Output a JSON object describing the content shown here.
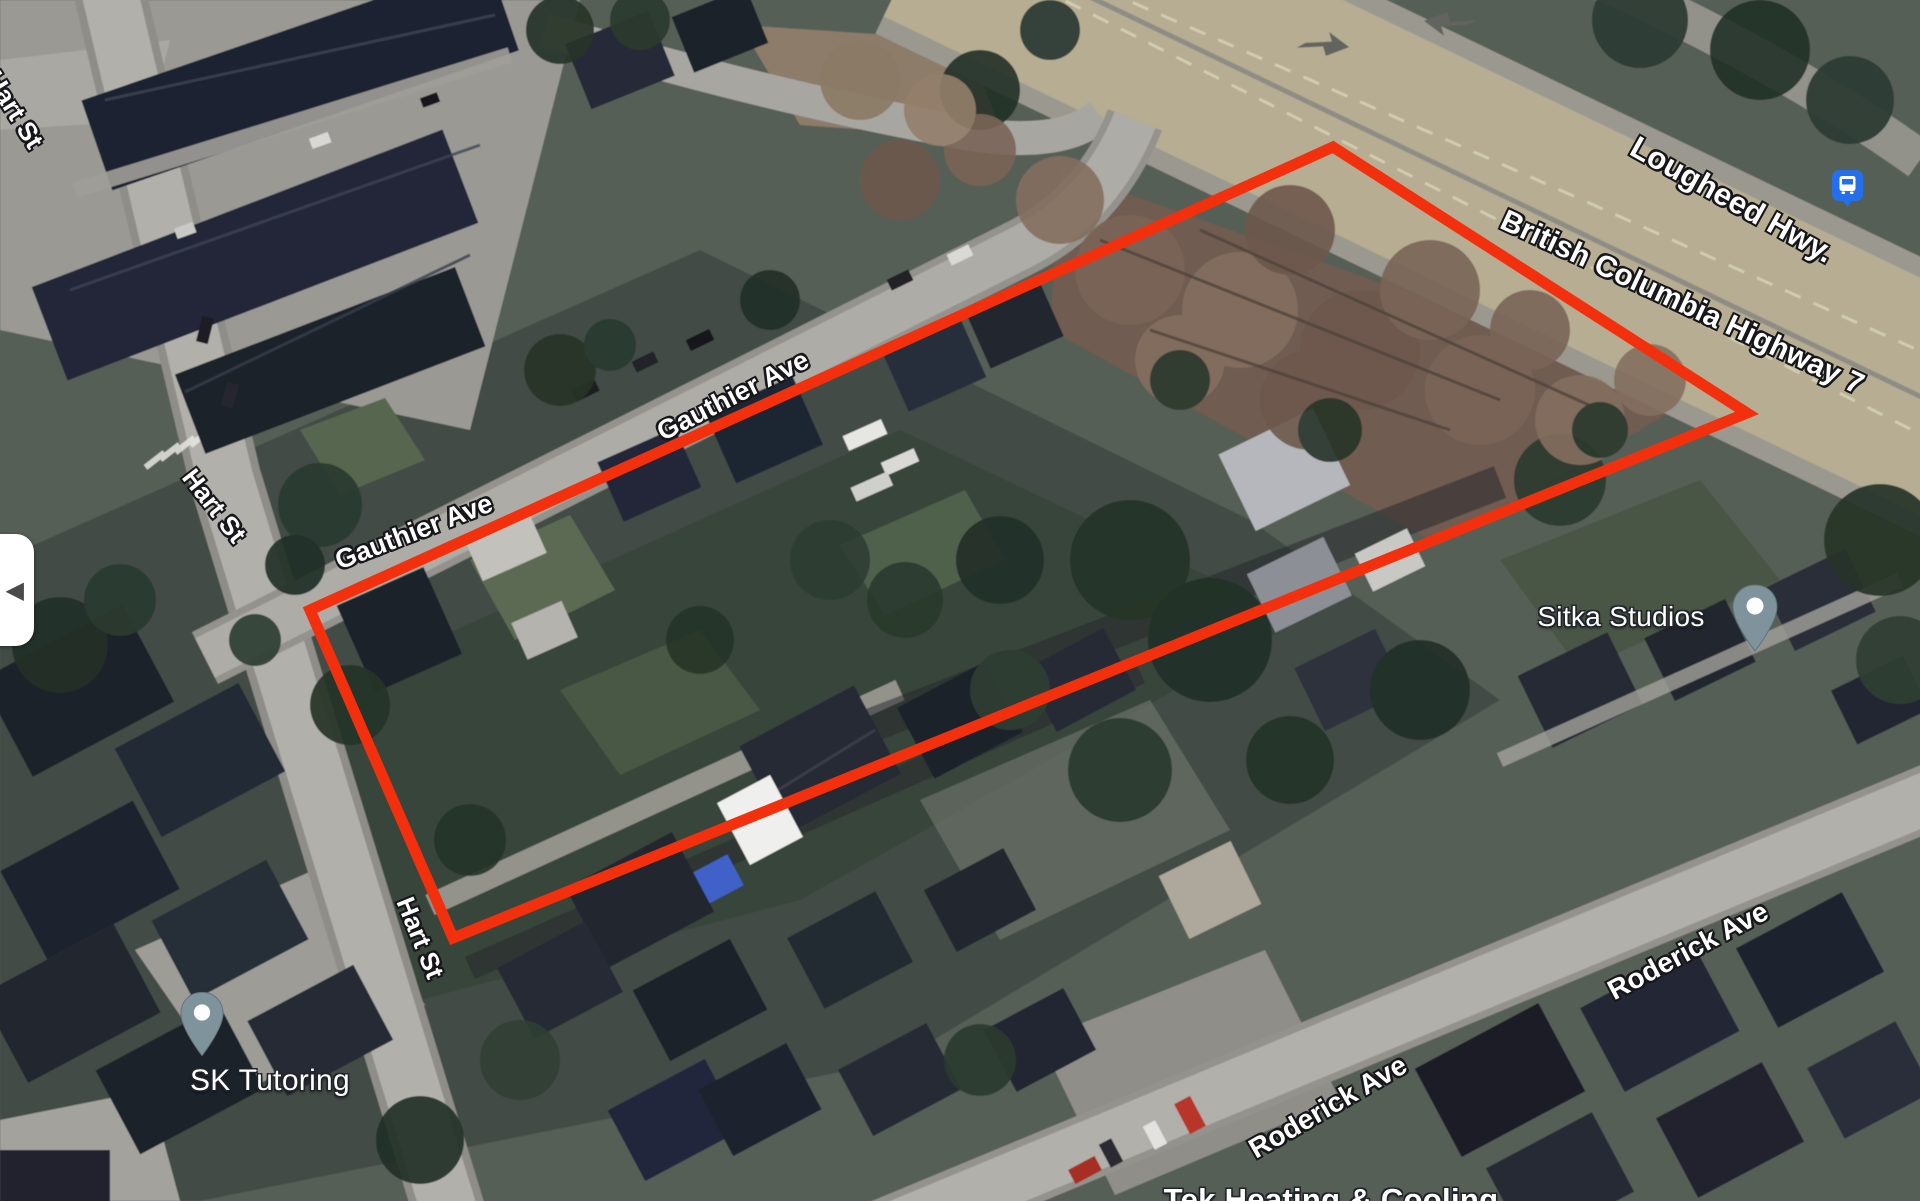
{
  "map": {
    "road_labels": [
      {
        "id": "hart-st-top",
        "text": "Hart St"
      },
      {
        "id": "hart-st-mid",
        "text": "Hart St"
      },
      {
        "id": "hart-st-bottom",
        "text": "Hart St"
      },
      {
        "id": "gauthier-ave-upper",
        "text": "Gauthier Ave"
      },
      {
        "id": "gauthier-ave-lower",
        "text": "Gauthier Ave"
      },
      {
        "id": "lougheed-hwy",
        "text": "Lougheed Hwy."
      },
      {
        "id": "bc-highway-7",
        "text": "British Columbia Highway 7"
      },
      {
        "id": "roderick-ave-left",
        "text": "Roderick Ave"
      },
      {
        "id": "roderick-ave-right",
        "text": "Roderick Ave"
      }
    ],
    "poi_labels": [
      {
        "id": "sitka-studios",
        "text": "Sitka Studios"
      },
      {
        "id": "sk-tutoring",
        "text": "SK Tutoring"
      },
      {
        "id": "tek-heating",
        "text": "Tek Heating & Cooling"
      }
    ],
    "icons": {
      "transit_stop": "bus-icon",
      "poi_pin": "map-pin-icon"
    },
    "colors": {
      "boundary_red": "#f2300d",
      "transit_blue": "#2570e8",
      "pin_gray": "#7e939c",
      "road_fill": "#b2b0ab",
      "highway_fill": "#b6ad92"
    }
  },
  "controls": {
    "collapse_arrow": "◀"
  }
}
